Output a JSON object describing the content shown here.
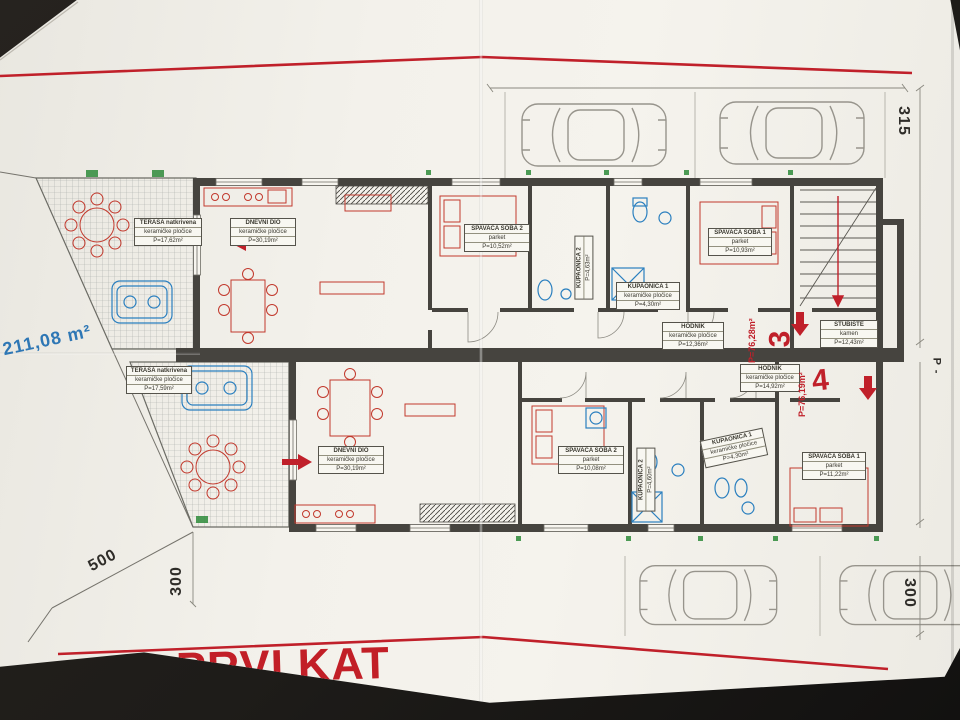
{
  "title": "PRVI KAT",
  "site_area_note": "211,08 m²",
  "dimensions": {
    "right_top": "315",
    "right_bottom": "300",
    "bottom_left_slant": "500",
    "bottom_left_vert": "300",
    "right_mid": "P -"
  },
  "units": [
    {
      "number": "3",
      "total_area": "P=76,28m²",
      "rooms": [
        {
          "name": "TERASA natkrivena",
          "floor": "keramičke pločice",
          "area": "P=17,62m²"
        },
        {
          "name": "DNEVNI DIO",
          "floor": "keramičke pločice",
          "area": "P=30,19m²"
        },
        {
          "name": "SPAVAĆA SOBA 2",
          "floor": "parket",
          "area": "P=10,52m²"
        },
        {
          "name": "KUPAONICA 2",
          "floor": "keramičke pločice",
          "area": "P=4,63m²"
        },
        {
          "name": "KUPAONICA 1",
          "floor": "keramičke pločice",
          "area": "P=4,30m²"
        },
        {
          "name": "SPAVAĆA SOBA 1",
          "floor": "parket",
          "area": "P=10,93m²"
        },
        {
          "name": "HODNIK",
          "floor": "keramičke pločice",
          "area": "P=12,36m²"
        },
        {
          "name": "STUBIŠTE",
          "floor": "kamen",
          "area": "P=12,43m²"
        }
      ]
    },
    {
      "number": "4",
      "total_area": "P=76,19m²",
      "rooms": [
        {
          "name": "TERASA natkrivena",
          "floor": "keramičke pločice",
          "area": "P=17,59m²"
        },
        {
          "name": "DNEVNI DIO",
          "floor": "keramičke pločice",
          "area": "P=30,19m²"
        },
        {
          "name": "SPAVAĆA SOBA 2",
          "floor": "parket",
          "area": "P=10,08m²"
        },
        {
          "name": "KUPAONICA 2",
          "floor": "keramičke pločice",
          "area": "P=4,60m²"
        },
        {
          "name": "KUPAONICA 1",
          "floor": "keramičke pločice",
          "area": "P=4,30m²"
        },
        {
          "name": "SPAVAĆA SOBA 1",
          "floor": "parket",
          "area": "P=11,22m²"
        },
        {
          "name": "HODNIK",
          "floor": "keramičke pločice",
          "area": "P=14,92m²"
        }
      ]
    }
  ]
}
